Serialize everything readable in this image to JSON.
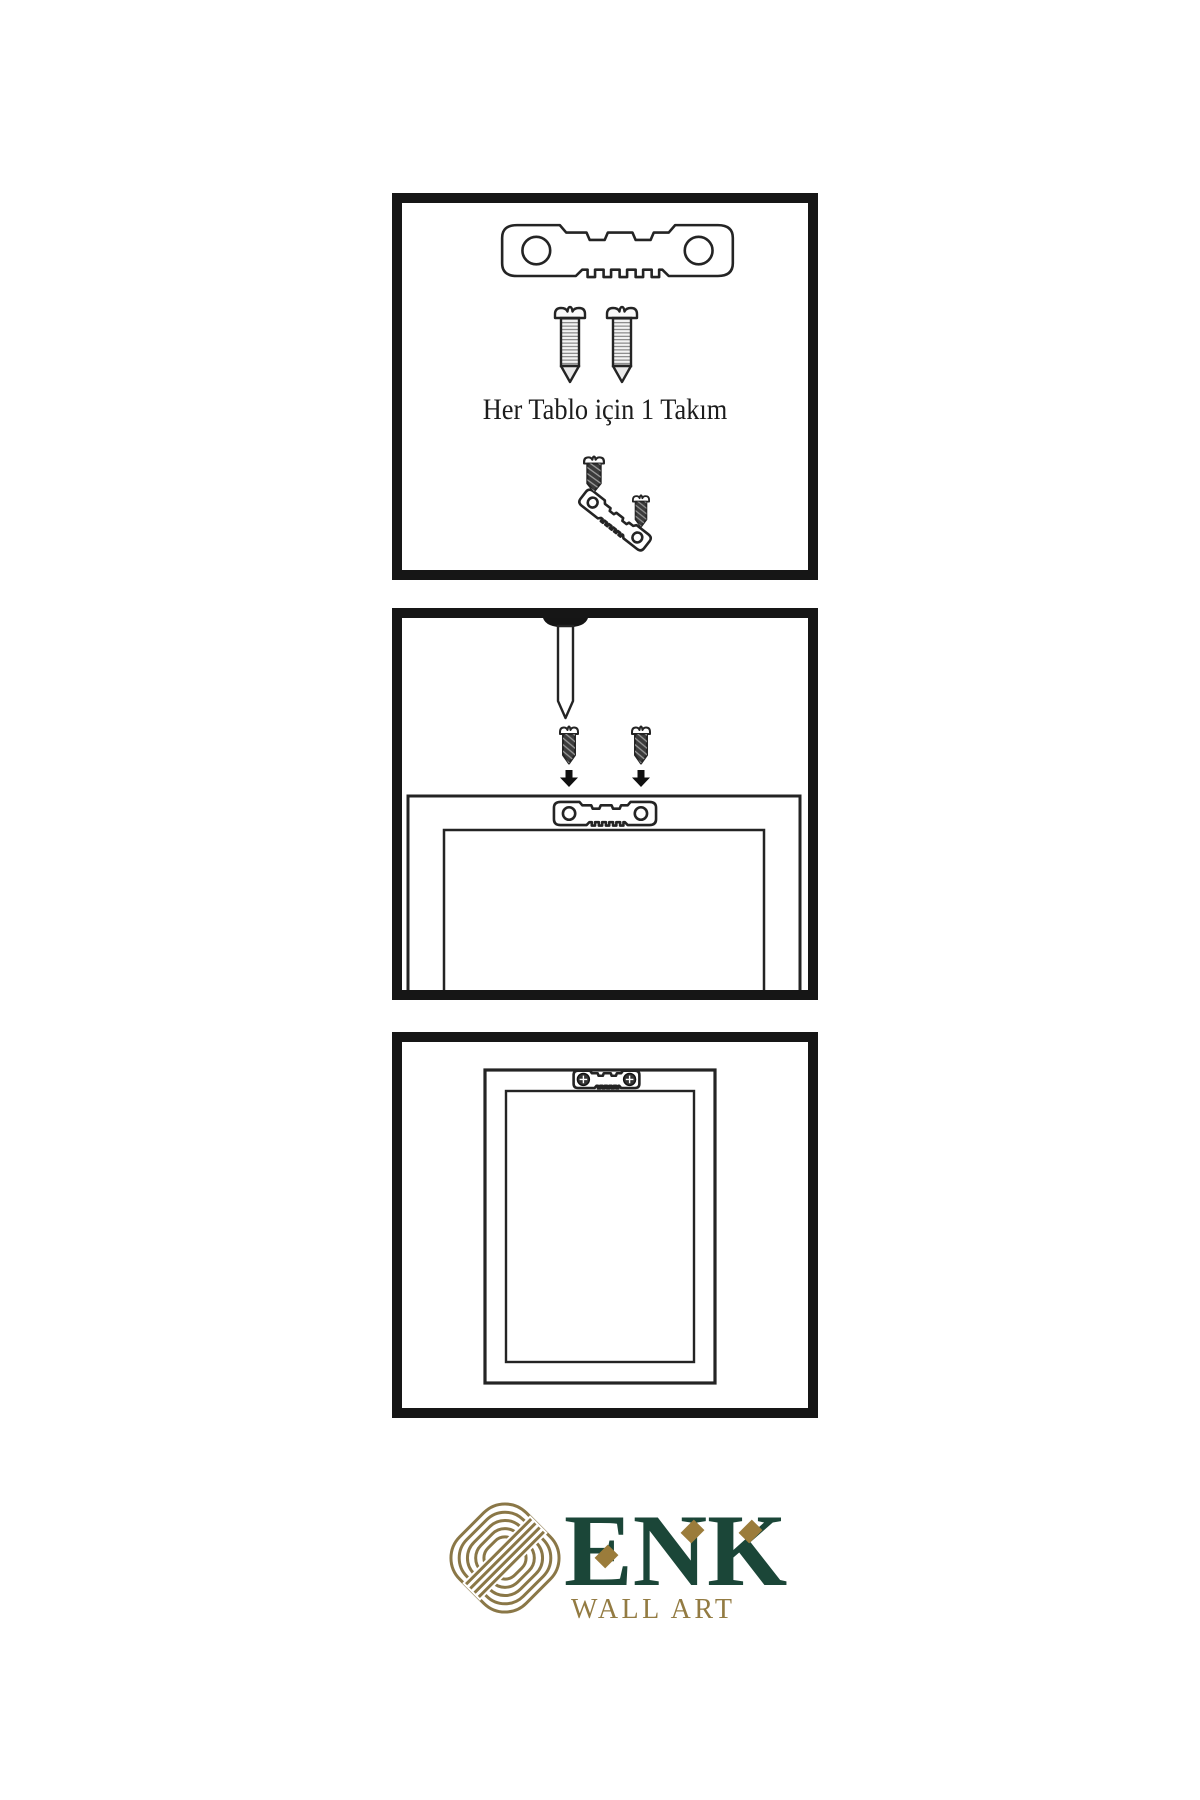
{
  "document": {
    "type": "wall-art-hanging-instruction-sheet",
    "background": "#ffffff",
    "line_color": "#242424",
    "panel_border_color": "#161616"
  },
  "panels": [
    {
      "name": "hardware-kit",
      "caption": "Her Tablo için 1 Takım",
      "items": [
        "sawtooth-hanger",
        "screw",
        "screw",
        "small-screw",
        "tilted-sawtooth-hanger",
        "small-screw"
      ]
    },
    {
      "name": "wall-nail-and-screw-placement",
      "items": [
        "nail-in-wall",
        "dark-screw",
        "dark-screw",
        "arrow-down",
        "arrow-down",
        "frame-back",
        "sawtooth-hanger"
      ]
    },
    {
      "name": "frame-hung-on-wall",
      "items": [
        "frame-front",
        "sawtooth-hanger-with-phillips-screws"
      ]
    }
  ],
  "icons": {
    "sawtooth-hanger": "metal plate, two round holes, sawtooth bottom edge",
    "screw": "slotted pan-head screw with threads",
    "dark-screw": "dark slotted screw",
    "nail": "nail driven into wall, black dome head",
    "arrow-down": "solid black downward arrow",
    "knot-logo": "concentric-line interlocking knot, gold"
  },
  "brand": {
    "name": "ENK",
    "tagline": "WALL ART",
    "name_color": "#1b4638",
    "tagline_color": "#937b42",
    "knot_color": "#8a7747",
    "diamond_color": "#9b7c3b"
  }
}
